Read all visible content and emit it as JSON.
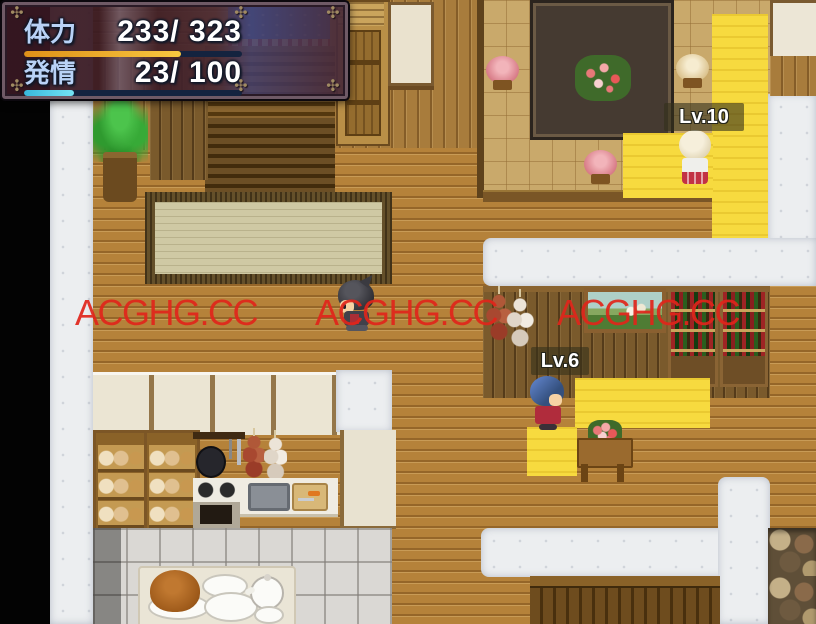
{
  "hud": {
    "ornament_icon": "✣",
    "rows": [
      {
        "label": "体力",
        "value_text": "233/ 323",
        "current": 233,
        "max": 323,
        "percent": 72,
        "bar_color_start": "#e09018",
        "bar_color_end": "#f8c840"
      },
      {
        "label": "発情",
        "value_text": "23/ 100",
        "current": 23,
        "max": 100,
        "percent": 23,
        "bar_color_start": "#38b8dc",
        "bar_color_end": "#74e4f4"
      }
    ]
  },
  "overlays": {
    "watermarks": [
      {
        "text": "ACGHG.CC"
      },
      {
        "text": "ACGHG.CC"
      },
      {
        "text": "ACGHG.CC"
      }
    ]
  },
  "entities": {
    "npc_blonde": {
      "level_label": "Lv.10"
    },
    "npc_blue": {
      "level_label": "Lv.6"
    }
  },
  "colors": {
    "watermark": "#e1251b",
    "hp_bar": "#e8a428",
    "arousal_bar": "#4cc8e4",
    "lit_tile": "#f7da3f",
    "snow_path": "#eceef0",
    "wood_floor": "#b5823a"
  }
}
